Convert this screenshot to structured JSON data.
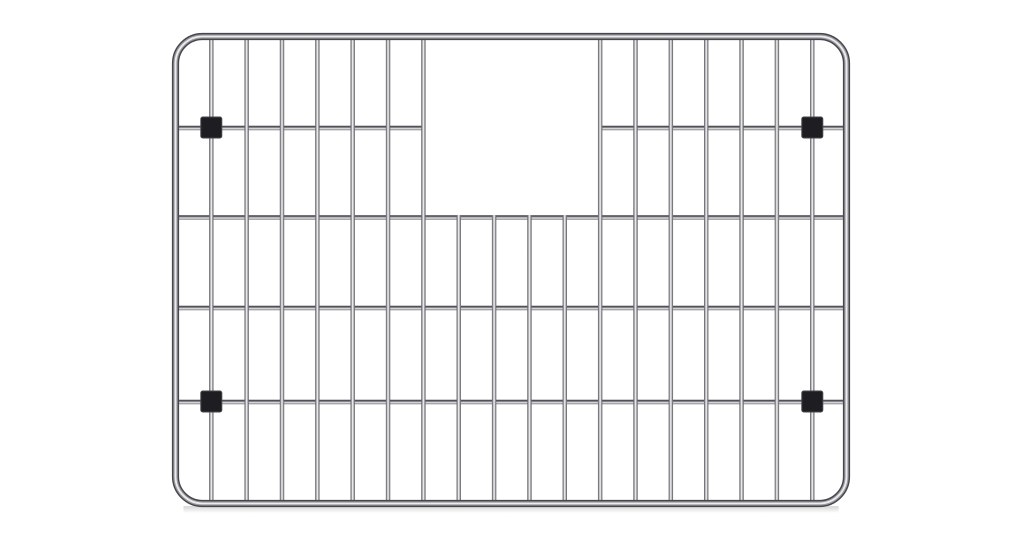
{
  "meta": {
    "description": "Stainless steel kitchen sink bottom grid with rear drain cutout and four black rubber feet, photographed on a white background",
    "background_color": "#ffffff"
  },
  "canvas": {
    "width": 1024,
    "height": 542
  },
  "grid": {
    "frame": {
      "x": 175.5,
      "y": 36.5,
      "width": 671,
      "height": 467,
      "corner_radius": 27,
      "tube_width": 7.2,
      "color_outer": "#46464b",
      "color_mid": "#98989e",
      "color_highlight": "#ececee"
    },
    "vertical_wires": {
      "count": 18,
      "x_start": 211.3,
      "spacing": 35.35,
      "y_top": 36.5,
      "y_bottom": 503.5,
      "width": 4.4,
      "short_indices": [
        7,
        8,
        9,
        10
      ],
      "short_y_top": 215,
      "edge_color": "#58585d",
      "mid_color": "#8c8c92",
      "core_color": "#fdfdfe"
    },
    "horizontal_wires": {
      "height": 4.4,
      "top_color": "#39393e",
      "mid_color": "#6f6f75",
      "light_color": "#e9e9ec",
      "bottom_color": "#77777d",
      "rows": [
        {
          "y": 128,
          "segments": [
            [
              175.5,
              423.4
            ],
            [
              600.2,
              846.5
            ]
          ]
        },
        {
          "y": 217.5,
          "segments": [
            [
              175.5,
              846.5
            ]
          ]
        },
        {
          "y": 308,
          "segments": [
            [
              175.5,
              846.5
            ]
          ]
        },
        {
          "y": 402,
          "segments": [
            [
              175.5,
              846.5
            ]
          ]
        }
      ]
    },
    "cutout": {
      "x1": 423.4,
      "x2": 600.2,
      "y1": 36.5,
      "y2": 217.5
    },
    "feet": {
      "size": 21,
      "fill_color": "#1d1d22",
      "edge_color": "#46464c",
      "positions": [
        [
          211.3,
          127.5
        ],
        [
          812.3,
          127.5
        ],
        [
          211.3,
          401.5
        ],
        [
          812.3,
          401.5
        ]
      ]
    },
    "shadow": {
      "color_start": "rgba(45,45,50,0.20)",
      "color_end": "rgba(45,45,50,0)",
      "height": 7
    }
  }
}
